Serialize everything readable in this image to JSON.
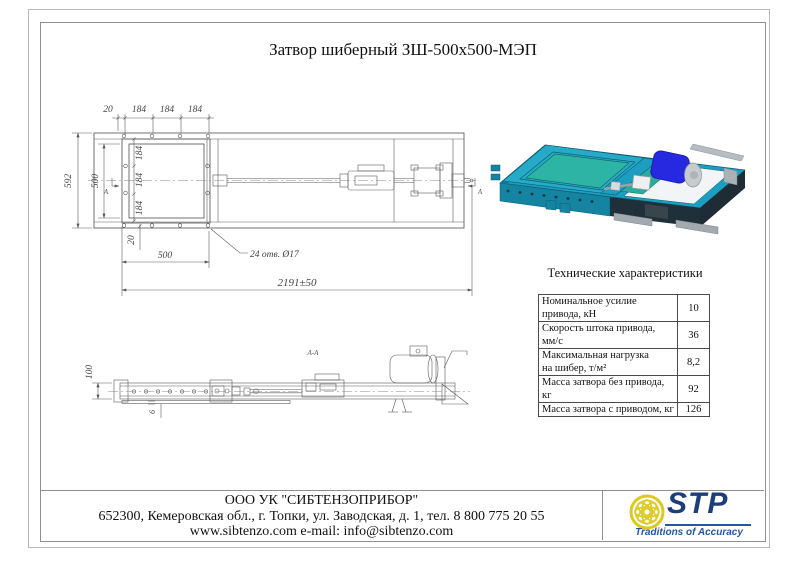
{
  "title": "Затвор шиберный ЗШ-500х500-МЭП",
  "top_view": {
    "dims_top": [
      "20",
      "184",
      "184",
      "184"
    ],
    "dim_height_outer": "592",
    "dim_height_inner": "500",
    "dims_inner_vertical": [
      "184",
      "184",
      "184"
    ],
    "dim_bottom_offset": "20",
    "dim_bottom_width": "500",
    "holes_note": "24 отв. Ø17",
    "dim_total_length": "2191±50",
    "section_letter": "А"
  },
  "side_view": {
    "section_label": "А-А",
    "dim_height": "100",
    "dim_plate_thickness": "6"
  },
  "specs": {
    "heading": "Технические характеристики",
    "rows": [
      {
        "name": "Номинальное усилие привода, кН",
        "value": "10"
      },
      {
        "name": "Скорость штока привода, мм/с",
        "value": "36"
      },
      {
        "name": "Максимальная нагрузка\nна шибер, т/м²",
        "value": "8,2"
      },
      {
        "name": "Масса затвора без привода, кг",
        "value": "92"
      },
      {
        "name": "Масса затвора с приводом, кг",
        "value": "126"
      }
    ]
  },
  "footer": {
    "company": "ООО УК \"СИБТЕНЗОПРИБОР\"",
    "address": "652300, Кемеровская обл., г. Топки, ул. Заводская, д. 1, тел. 8 800 775 20 55",
    "web": "www.sibtenzo.com e-mail: info@sibtenzo.com"
  },
  "logo": {
    "name": "STP",
    "tagline": "Traditions of Accuracy"
  },
  "colors": {
    "valve_body_teal": "#1b9ec0",
    "gate_plate_green": "#2eb4a4",
    "motor_blue": "#2629e0",
    "dark_face": "#1e2c35",
    "metal_gray": "#a2aab0",
    "logo_yellow": "#ddc91c",
    "logo_blue": "#1d3d7c"
  }
}
